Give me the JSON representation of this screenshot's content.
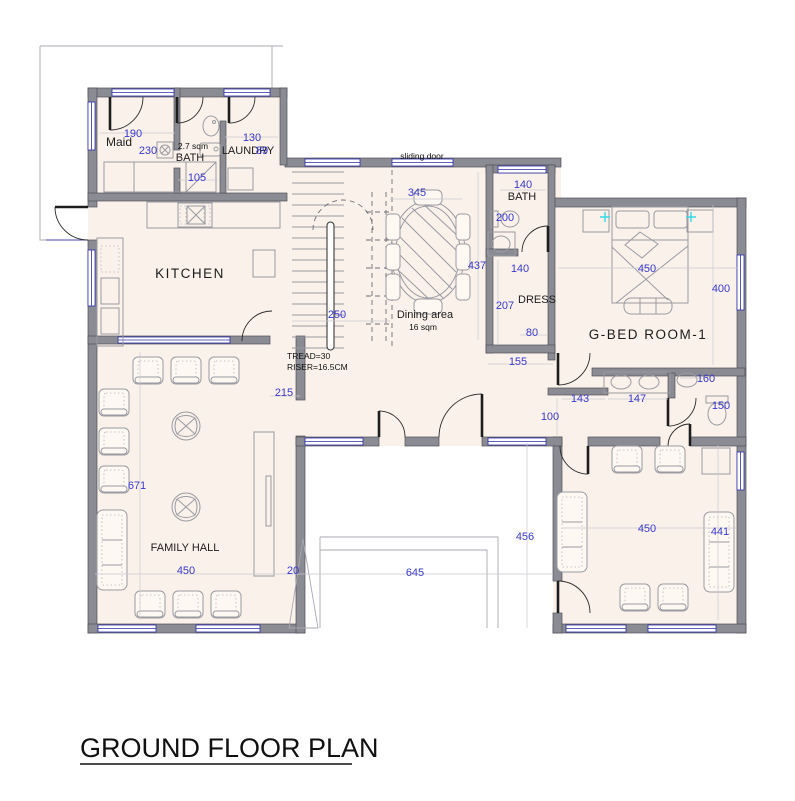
{
  "title": "GROUND FLOOR PLAN",
  "rooms": {
    "maid": "Maid",
    "bath_tl": "BATH",
    "bath_tl_area": "2.7 sqm",
    "laundry": "LAUNDRY",
    "kitchen": "KITCHEN",
    "dining": "Dining area",
    "dining_area": "16 sqm",
    "bath_tr": "BATH",
    "dress": "DRESS",
    "bedroom": "G-BED ROOM-1",
    "family_hall": "FAMILY HALL"
  },
  "notes": {
    "sliding_door": "sliding door",
    "tread": "TREAD=30",
    "riser": "RISER=16.5CM"
  },
  "dims": {
    "maid_w": "190",
    "maid_d": "230",
    "bath_tl_w": "105",
    "laundry_w": "130",
    "laundry_n": "89",
    "dining_w": "345",
    "dining_h": "437",
    "stair_w": "250",
    "hall_top": "215",
    "bath_tr_w": "140",
    "bath_tr_h": "200",
    "dress_top": "140",
    "dress_h": "207",
    "dress_w2": "80",
    "dress_w3": "155",
    "bed_w": "450",
    "bed_h": "400",
    "wc_a": "143",
    "wc_b": "147",
    "wc_c": "100",
    "wc_d": "160",
    "wc_e": "150",
    "fh_h": "671",
    "fh_w": "450",
    "fh_gap": "20",
    "porch_w": "645",
    "porch_h": "456",
    "sit_w": "450",
    "sit_h": "441"
  },
  "colors": {
    "wall": "#8b8b93",
    "floor": "#faf2ea",
    "dimension_text": "#3737cf",
    "window": "#2a2ab0",
    "lamp": "#35d8e8"
  }
}
